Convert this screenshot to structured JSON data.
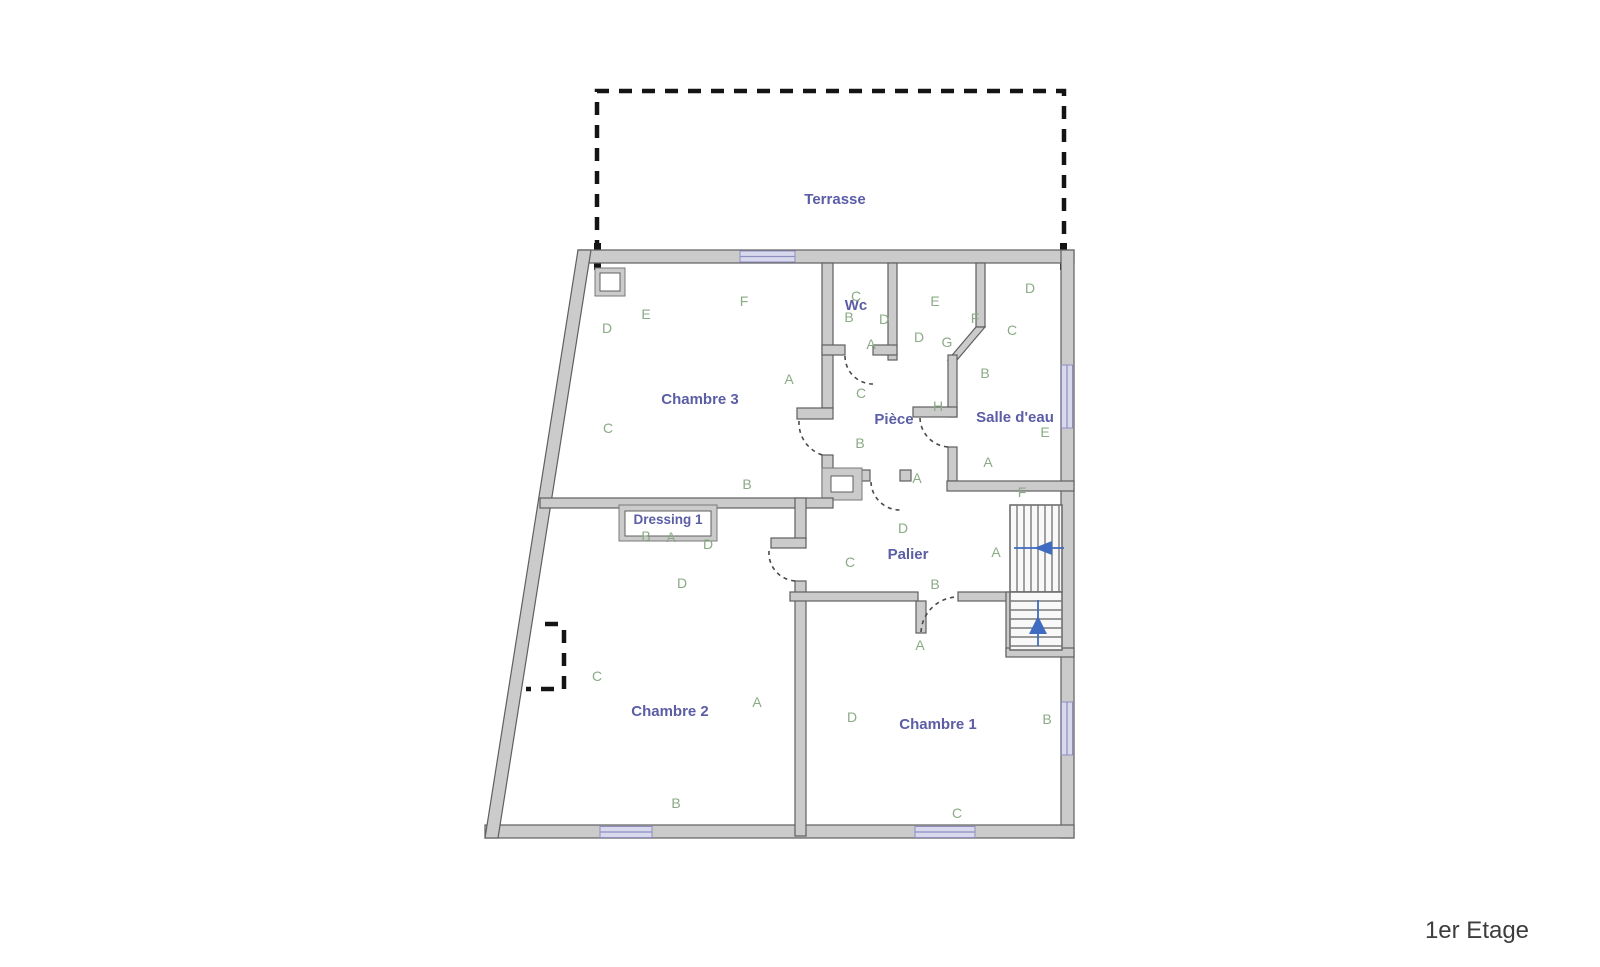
{
  "floor_label": "1er Etage",
  "colors": {
    "wall_fill": "#cbcbcb",
    "wall_stroke": "#5f5f5f",
    "room_label": "#5b5da5",
    "marker_green": "#8aab85",
    "window_lavender": "#d9d9ee",
    "stair_arrow_blue": "#3f6bc0",
    "dashed_black": "#141414"
  },
  "rooms": [
    {
      "id": "terrasse",
      "label": "Terrasse",
      "x": 835,
      "y": 204
    },
    {
      "id": "chambre-3",
      "label": "Chambre 3",
      "x": 700,
      "y": 404
    },
    {
      "id": "wc",
      "label": "Wc",
      "x": 856,
      "y": 310
    },
    {
      "id": "piece",
      "label": "Pièce",
      "x": 894,
      "y": 424
    },
    {
      "id": "salle-deau",
      "label": "Salle d'eau",
      "x": 1015,
      "y": 422
    },
    {
      "id": "dressing-1",
      "label": "Dressing 1",
      "x": 668,
      "y": 524,
      "small": true
    },
    {
      "id": "palier",
      "label": "Palier",
      "x": 908,
      "y": 559
    },
    {
      "id": "chambre-2",
      "label": "Chambre 2",
      "x": 670,
      "y": 716
    },
    {
      "id": "chambre-1",
      "label": "Chambre 1",
      "x": 938,
      "y": 729
    }
  ],
  "markers": [
    {
      "room": "chambre-3",
      "letter": "D",
      "x": 607,
      "y": 333
    },
    {
      "room": "chambre-3",
      "letter": "E",
      "x": 646,
      "y": 319
    },
    {
      "room": "chambre-3",
      "letter": "F",
      "x": 744,
      "y": 306
    },
    {
      "room": "chambre-3",
      "letter": "A",
      "x": 789,
      "y": 384
    },
    {
      "room": "chambre-3",
      "letter": "C",
      "x": 608,
      "y": 433
    },
    {
      "room": "chambre-3",
      "letter": "B",
      "x": 747,
      "y": 489
    },
    {
      "room": "wc",
      "letter": "C",
      "x": 856,
      "y": 301
    },
    {
      "room": "wc",
      "letter": "B",
      "x": 849,
      "y": 322
    },
    {
      "room": "wc",
      "letter": "D",
      "x": 884,
      "y": 324
    },
    {
      "room": "wc",
      "letter": "A",
      "x": 871,
      "y": 349
    },
    {
      "room": "wc",
      "letter": "C",
      "x": 861,
      "y": 398
    },
    {
      "room": "piece",
      "letter": "E",
      "x": 935,
      "y": 306
    },
    {
      "room": "piece",
      "letter": "D",
      "x": 919,
      "y": 342
    },
    {
      "room": "piece",
      "letter": "G",
      "x": 947,
      "y": 347
    },
    {
      "room": "piece",
      "letter": "F",
      "x": 975,
      "y": 323
    },
    {
      "room": "piece",
      "letter": "B",
      "x": 860,
      "y": 448
    },
    {
      "room": "piece",
      "letter": "H",
      "x": 938,
      "y": 411
    },
    {
      "room": "piece",
      "letter": "A",
      "x": 917,
      "y": 483
    },
    {
      "room": "salle-deau",
      "letter": "D",
      "x": 1030,
      "y": 293
    },
    {
      "room": "salle-deau",
      "letter": "C",
      "x": 1012,
      "y": 335
    },
    {
      "room": "salle-deau",
      "letter": "B",
      "x": 985,
      "y": 378
    },
    {
      "room": "salle-deau",
      "letter": "E",
      "x": 1045,
      "y": 437
    },
    {
      "room": "salle-deau",
      "letter": "A",
      "x": 988,
      "y": 467
    },
    {
      "room": "salle-deau",
      "letter": "F",
      "x": 1022,
      "y": 497
    },
    {
      "room": "palier",
      "letter": "D",
      "x": 903,
      "y": 533
    },
    {
      "room": "palier",
      "letter": "C",
      "x": 850,
      "y": 567
    },
    {
      "room": "palier",
      "letter": "A",
      "x": 996,
      "y": 557
    },
    {
      "room": "palier",
      "letter": "B",
      "x": 935,
      "y": 589
    },
    {
      "room": "palier",
      "letter": "A",
      "x": 920,
      "y": 650
    },
    {
      "room": "dressing-1",
      "letter": "B",
      "x": 646,
      "y": 541
    },
    {
      "room": "dressing-1",
      "letter": "A",
      "x": 671,
      "y": 542
    },
    {
      "room": "dressing-1",
      "letter": "D",
      "x": 708,
      "y": 549
    },
    {
      "room": "chambre-2",
      "letter": "D",
      "x": 682,
      "y": 588
    },
    {
      "room": "chambre-2",
      "letter": "C",
      "x": 597,
      "y": 681
    },
    {
      "room": "chambre-2",
      "letter": "A",
      "x": 757,
      "y": 707
    },
    {
      "room": "chambre-2",
      "letter": "B",
      "x": 676,
      "y": 808
    },
    {
      "room": "chambre-1",
      "letter": "D",
      "x": 852,
      "y": 722
    },
    {
      "room": "chambre-1",
      "letter": "B",
      "x": 1047,
      "y": 724
    },
    {
      "room": "chambre-1",
      "letter": "C",
      "x": 957,
      "y": 818
    }
  ]
}
